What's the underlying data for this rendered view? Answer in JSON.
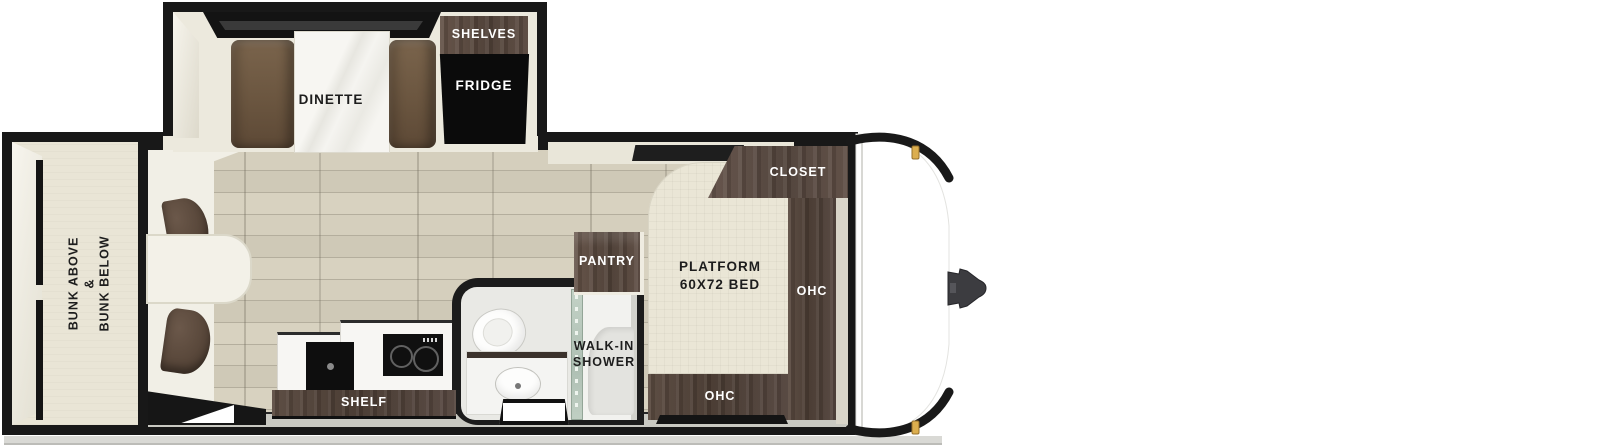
{
  "plan": {
    "type": "travel-trailer-floorplan"
  },
  "labels": {
    "dinette": "DINETTE",
    "shelves": "SHELVES",
    "fridge": "FRIDGE",
    "bunk_line1": "BUNK ABOVE",
    "bunk_line2": "&",
    "bunk_line3": "BUNK BELOW",
    "shelf": "SHELF",
    "pantry": "PANTRY",
    "walkin_line1": "WALK-IN",
    "walkin_line2": "SHOWER",
    "bed_line1": "PLATFORM",
    "bed_line2": "60X72 BED",
    "closet": "CLOSET",
    "ohc": "OHC"
  },
  "colors": {
    "wall_outline": "#181818",
    "dark_wood_cabinet": "#4e4037",
    "dinette_seat_brown": "#6b5640",
    "wood_floor": "#d2ccba",
    "bed_cream": "#eae6d6",
    "fridge_black": "#0b0b0b",
    "exterior_white": "#ffffff",
    "marker_light_gold": "#dcae4e",
    "shower_glass_green": "#b9c8bd",
    "ground_gray": "#d9d9d5"
  }
}
